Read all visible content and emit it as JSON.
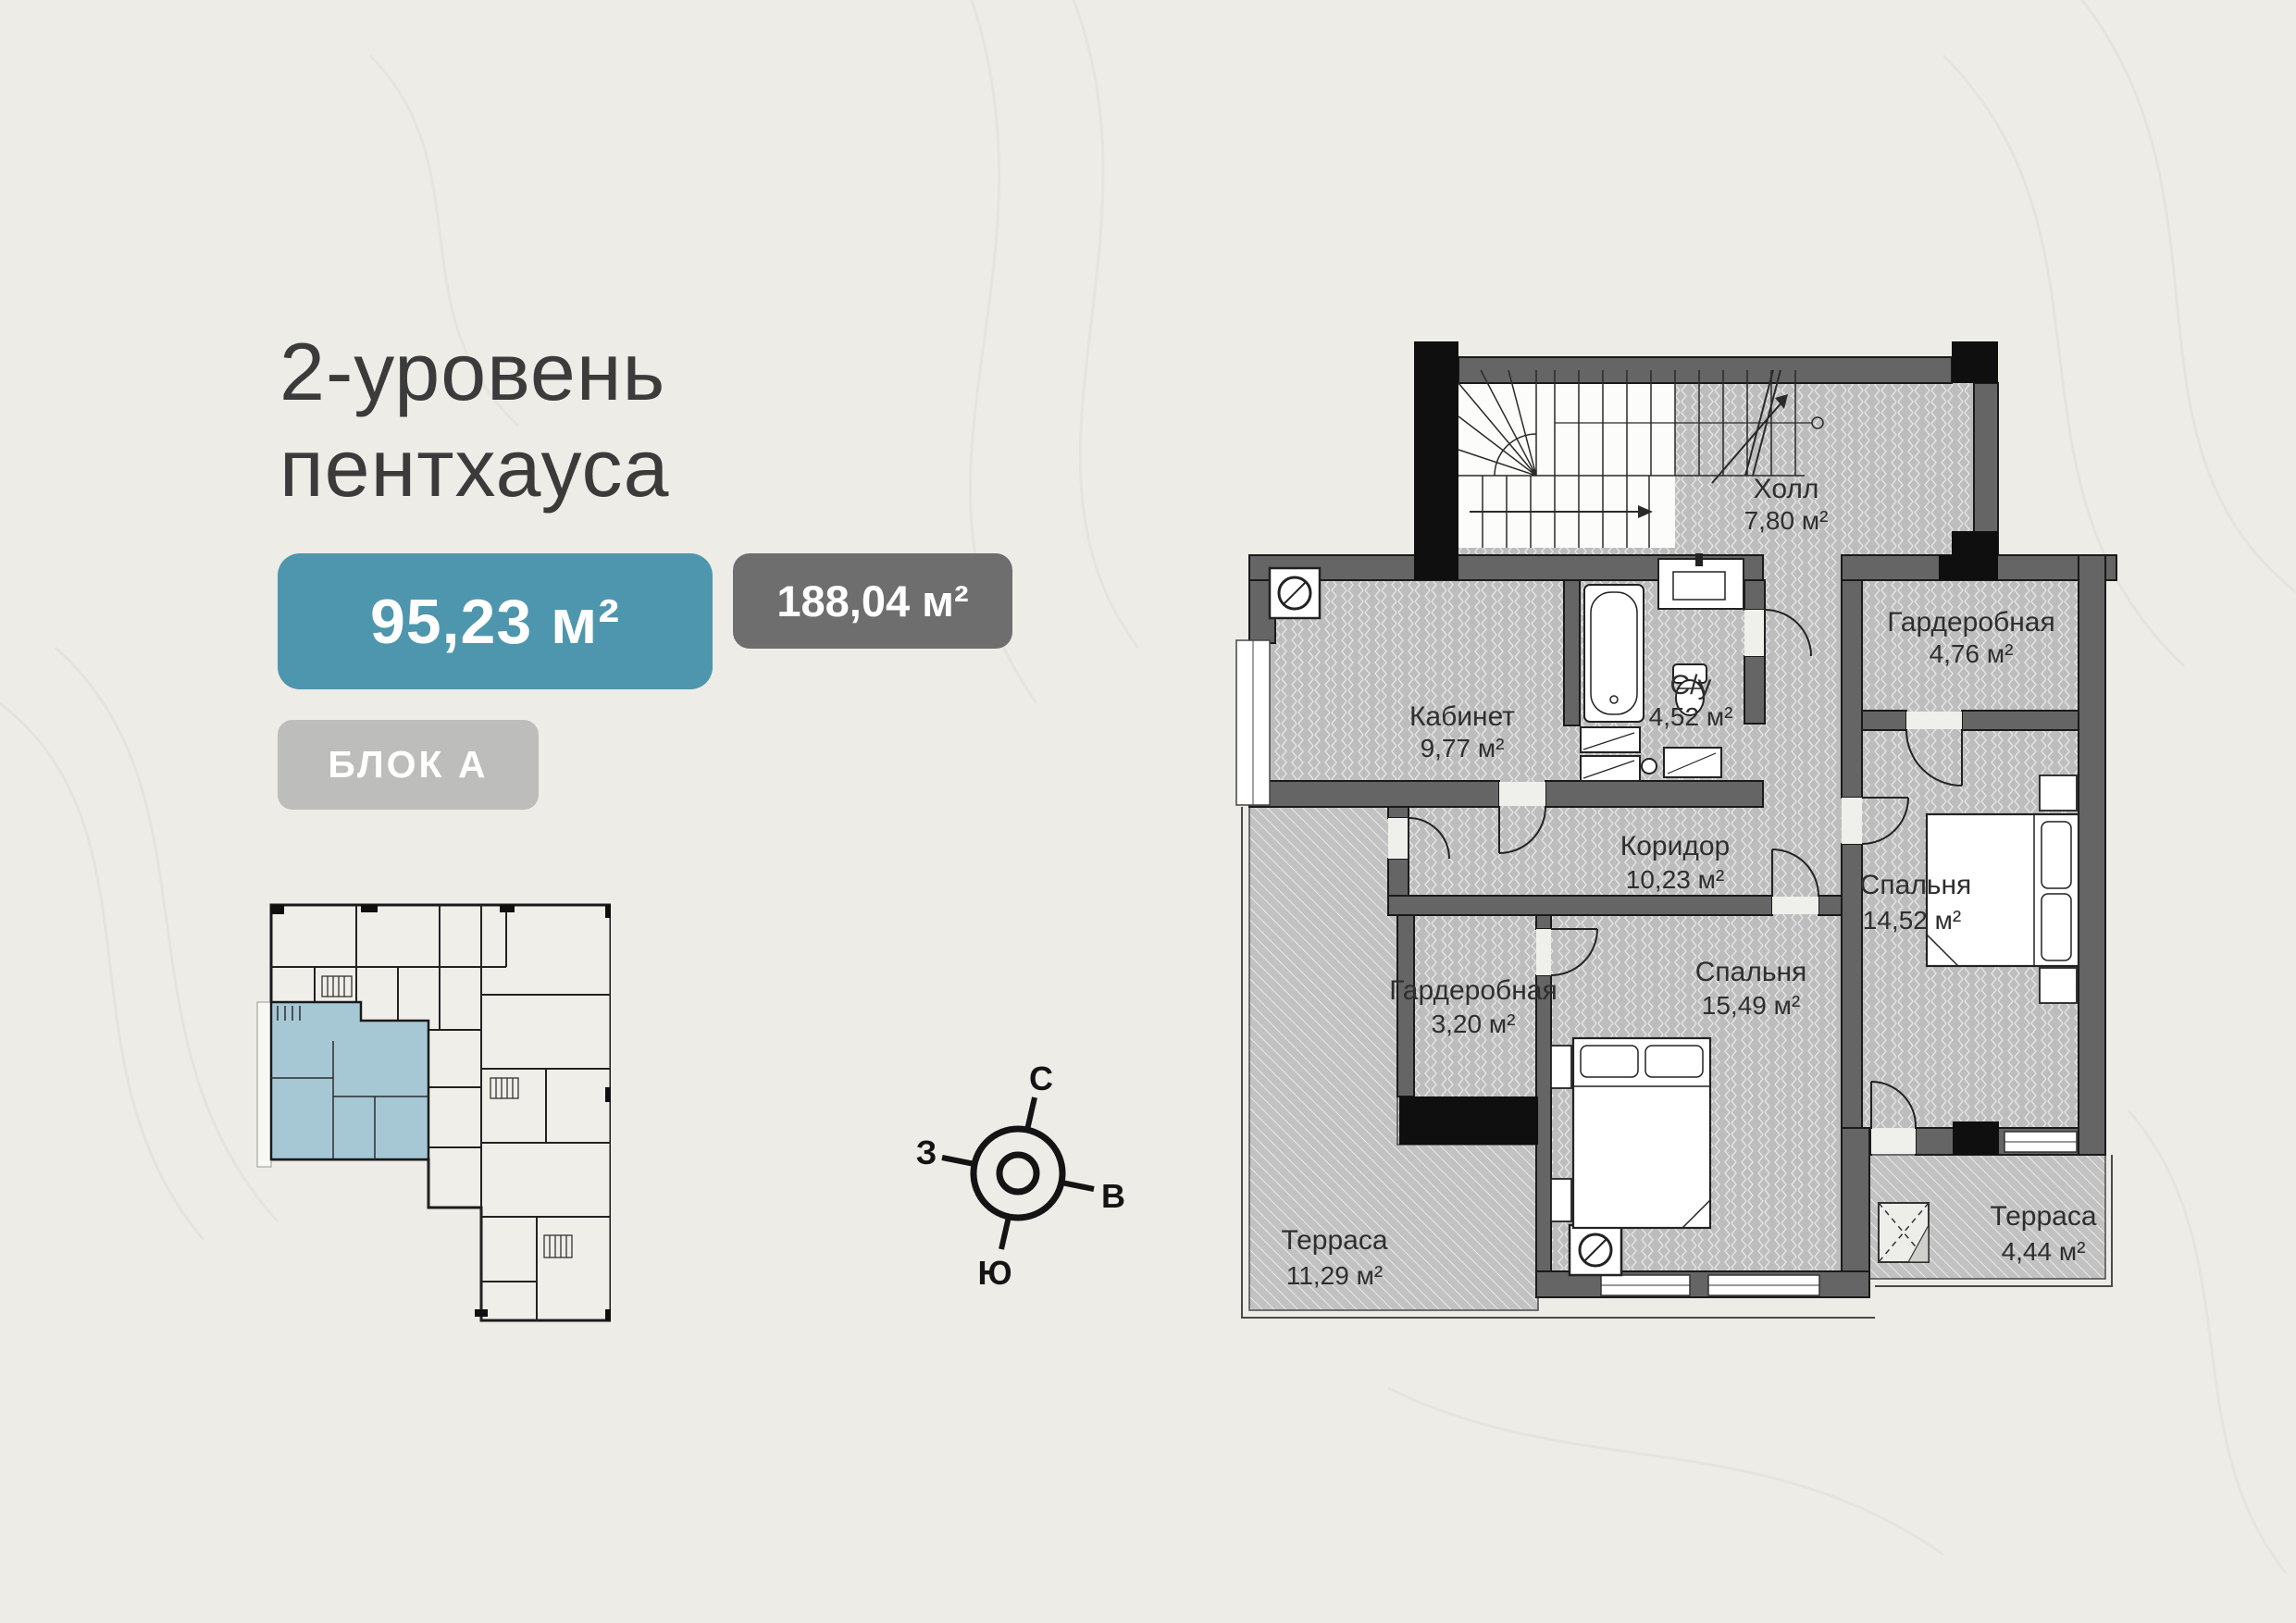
{
  "header": {
    "title_line1": "2-уровень",
    "title_line2": "пентхауса"
  },
  "badges": {
    "level_area": "95,23 м²",
    "total_area": "188,04 м²",
    "block": "БЛОК А"
  },
  "colors": {
    "accent": "#4E96AD",
    "badge_dark": "#6E6E6F",
    "badge_light": "#BDBDBB",
    "unit_highlight": "#A6C8D5",
    "wall_gray": "#656565",
    "floor_gray": "#BDBDBD"
  },
  "compass": {
    "north": "С",
    "south": "Ю",
    "west": "З",
    "east": "В"
  },
  "floor_plan": {
    "rooms": [
      {
        "name": "Холл",
        "area": "7,80 м²"
      },
      {
        "name": "Кабинет",
        "area": "9,77 м²"
      },
      {
        "name": "С/у",
        "area": "4,52 м²"
      },
      {
        "name": "Гардеробная",
        "area": "4,76 м²"
      },
      {
        "name": "Коридор",
        "area": "10,23 м²"
      },
      {
        "name": "Спальня",
        "area": "14,52 м²"
      },
      {
        "name": "Гардеробная",
        "area": "3,20 м²"
      },
      {
        "name": "Спальня",
        "area": "15,49 м²"
      },
      {
        "name": "Терраса",
        "area": "11,29 м²"
      },
      {
        "name": "Терраса",
        "area": "4,44 м²"
      }
    ]
  }
}
